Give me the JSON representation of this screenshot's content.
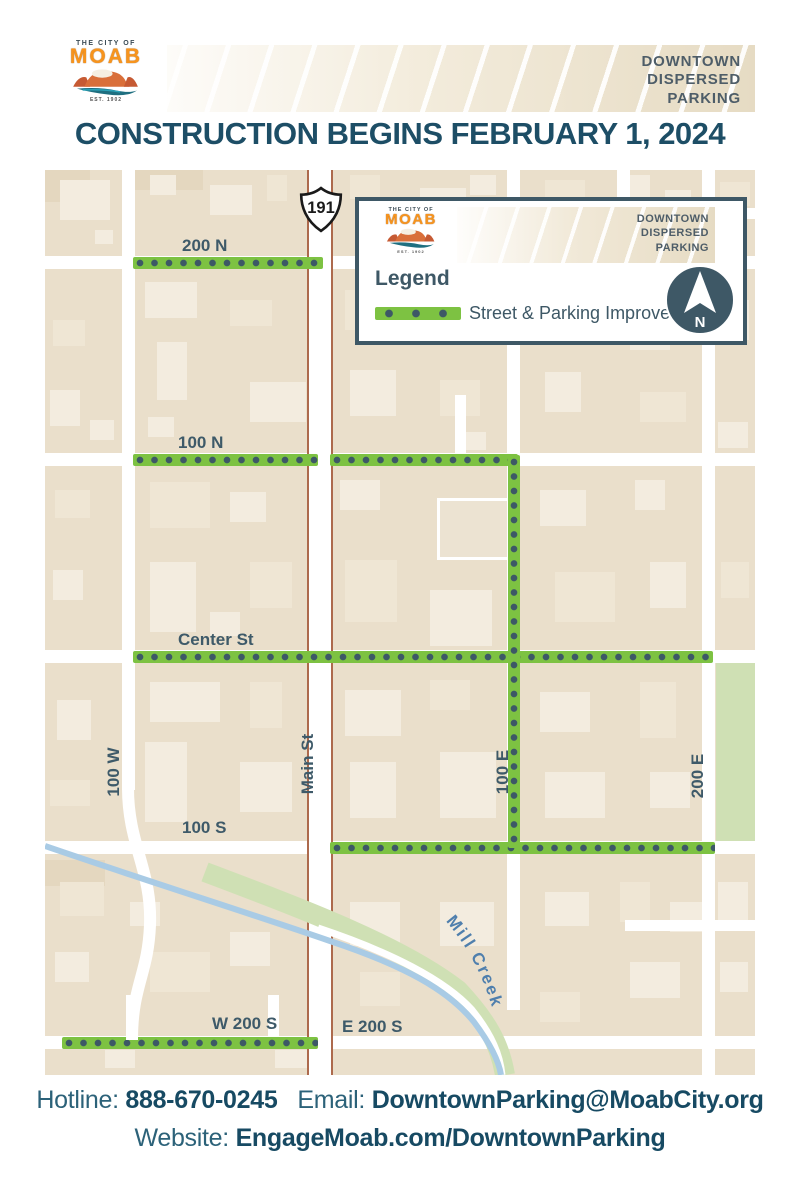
{
  "logo": {
    "tagline": "THE CITY OF",
    "name": "MOAB",
    "est": "EST. 1902"
  },
  "header": {
    "program_lines": [
      "DOWNTOWN",
      "DISPERSED",
      "PARKING"
    ]
  },
  "title": "CONSTRUCTION BEGINS FEBRUARY 1, 2024",
  "map": {
    "route_shield": "191",
    "street_labels": {
      "n200": "200 N",
      "n100": "100 N",
      "center": "Center St",
      "s100": "100 S",
      "w200s": "W 200 S",
      "e200s": "E 200 S",
      "w100": "100 W",
      "main": "Main St",
      "e100": "100 E",
      "e200": "200 E",
      "creek": "Mill Creek"
    },
    "improved_streets": [
      "200 N",
      "100 N",
      "100 E",
      "Center St",
      "100 S",
      "W 200 S"
    ],
    "legend": {
      "heading": "Legend",
      "item": "Street & Parking Improvement",
      "north_label": "N"
    },
    "colors": {
      "improvement_green": "#7dc242",
      "dot_slate": "#3d5866"
    }
  },
  "footer": {
    "hotline_label": "Hotline:",
    "hotline": "888-670-0245",
    "email_label": "Email:",
    "email": "DowntownParking@MoabCity.org",
    "website_label": "Website:",
    "website": "EngageMoab.com/DowntownParking"
  }
}
